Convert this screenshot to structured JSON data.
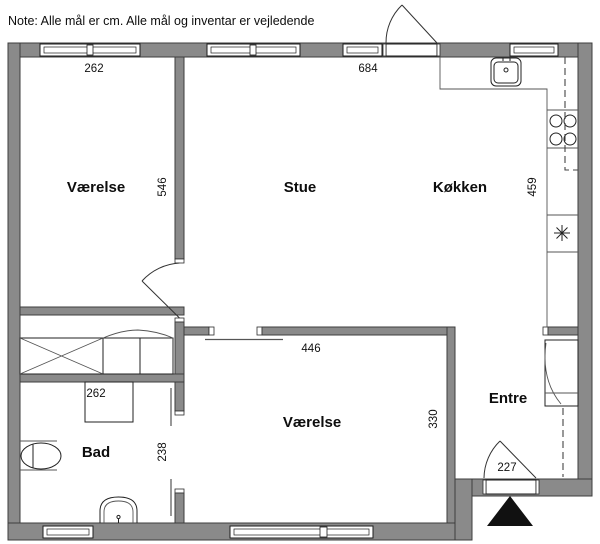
{
  "note": "Note: Alle mål er cm. Alle mål og inventar er vejledende",
  "colors": {
    "wall_fill": "#8a8a8a",
    "wall_stroke": "#3d3d3d",
    "entrance_arrow": "#111111"
  },
  "rooms": {
    "vaerelse_nw": {
      "name": "Værelse",
      "width_cm": "262",
      "depth_cm": "546"
    },
    "stue": {
      "name": "Stue",
      "width_cm": "684"
    },
    "koekken": {
      "name": "Køkken",
      "depth_cm": "459"
    },
    "vaerelse_s": {
      "name": "Værelse",
      "width_cm": "446",
      "depth_cm": "330"
    },
    "bad": {
      "name": "Bad",
      "width_cm": "262",
      "depth_cm": "238"
    },
    "entre": {
      "name": "Entre",
      "entrance_width_cm": "227"
    }
  }
}
